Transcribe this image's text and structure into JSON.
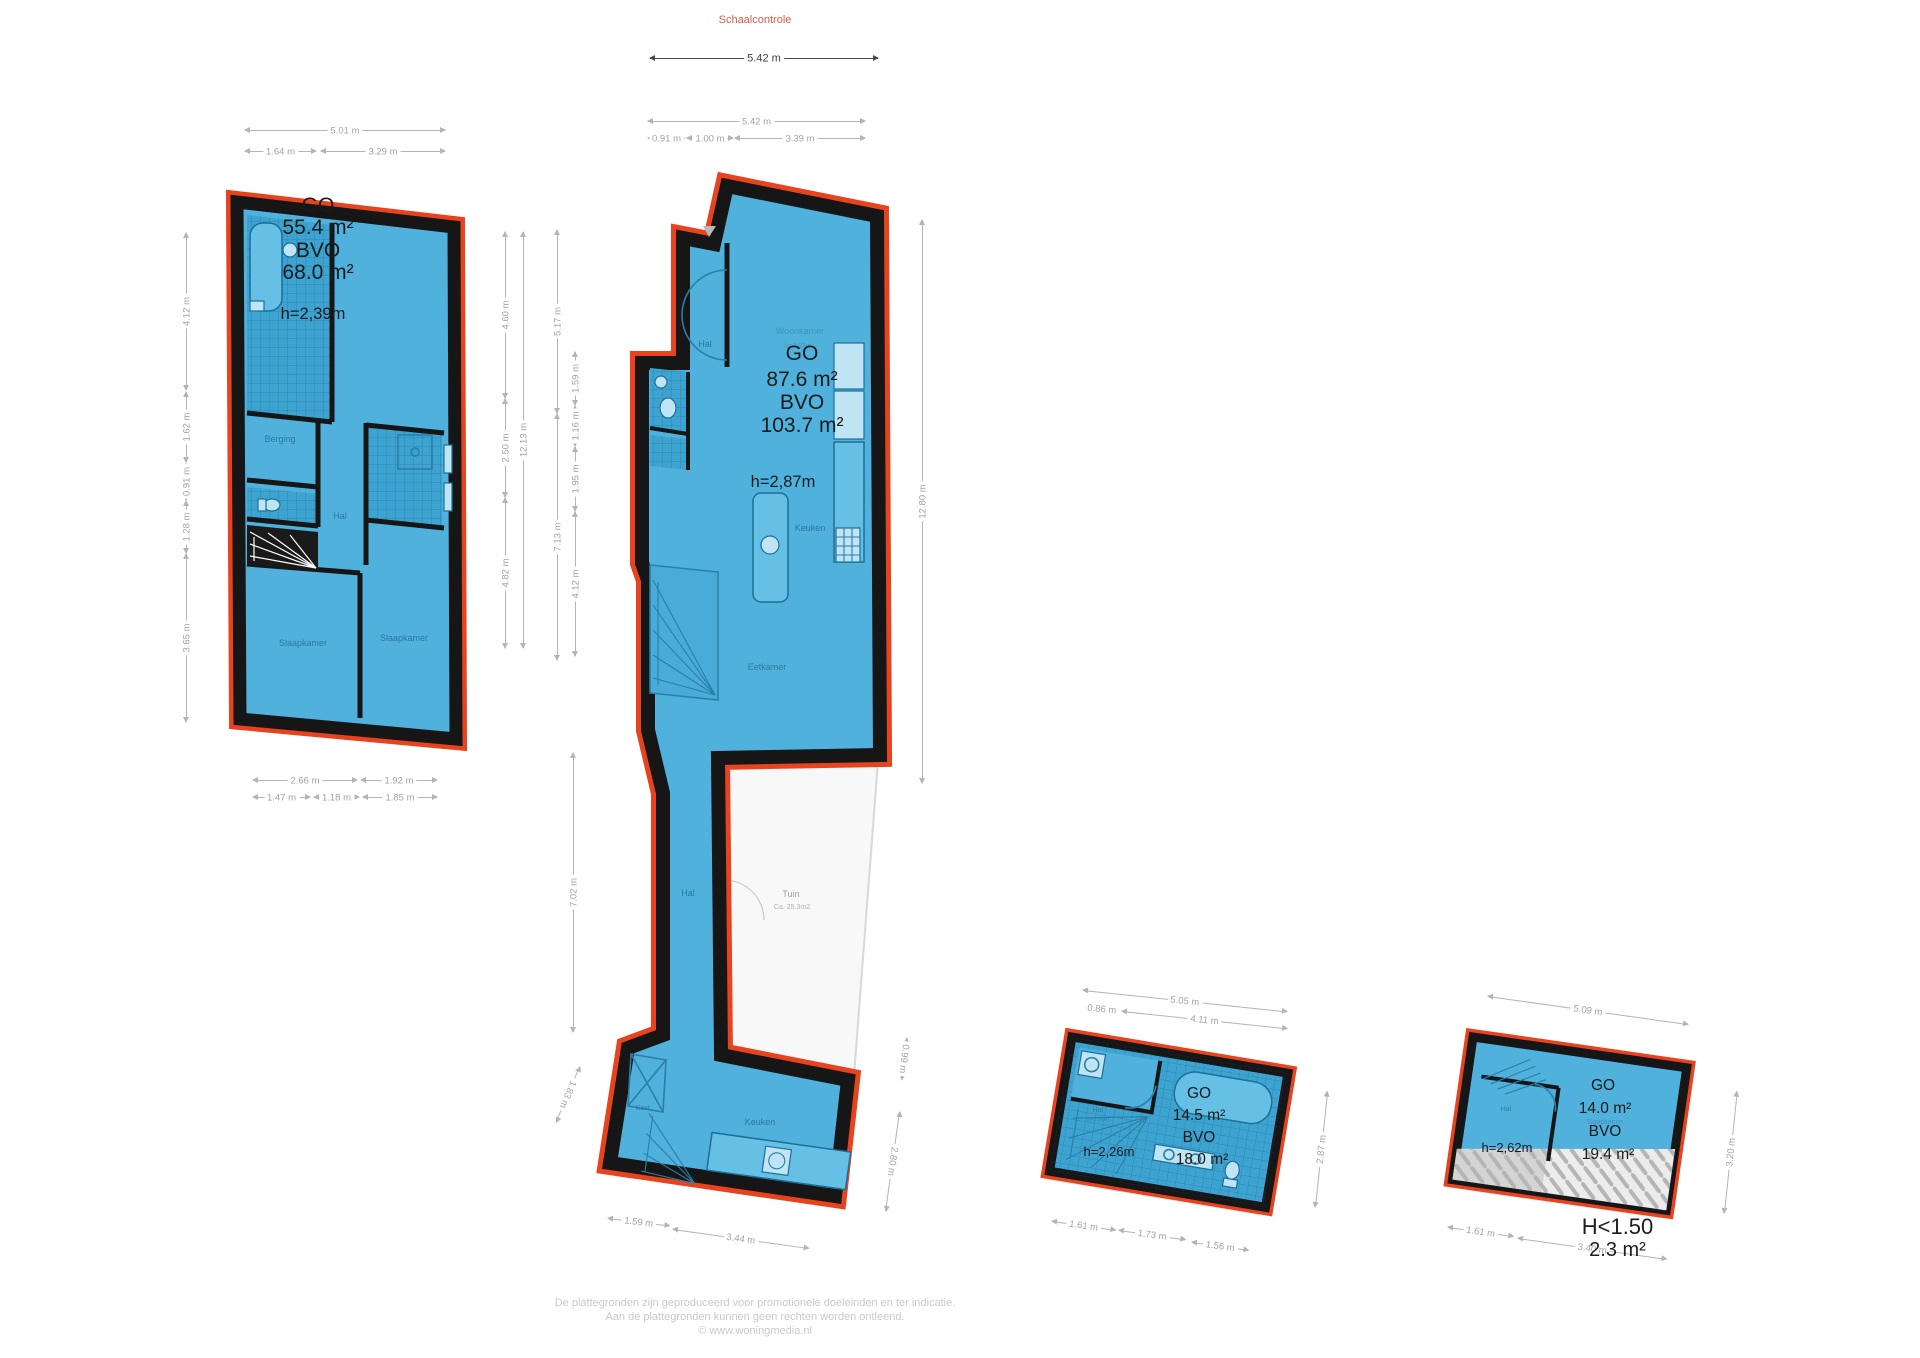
{
  "header": {
    "title": "Schaalcontrole"
  },
  "colors": {
    "accent_red": "#e8431f",
    "plan_blue": "#4fb1dc",
    "plan_blue_tiled": "#3da4d2",
    "wall_black": "#161616",
    "dim_gray": "#b4b4b4",
    "room_label_blue": "#2c7396",
    "title_red": "#d95b47",
    "footer_gray": "#c9c9c9"
  },
  "plans": {
    "first_floor": {
      "go_label": "GO",
      "go_value": "55.4 m²",
      "bvo_label": "BVO",
      "bvo_value": "68.0 m²",
      "height": "h=2,39m",
      "rooms": {
        "berging": "Berging",
        "hal": "Hal",
        "bedroom_left": "Slaapkamer",
        "bedroom_right": "Slaapkamer"
      }
    },
    "ground_floor": {
      "go_label": "GO",
      "go_value": "87.6 m²",
      "bvo_label": "BVO",
      "bvo_value": "103.7 m²",
      "height": "h=2,87m",
      "rooms": {
        "woonkamer": "Woonkamer",
        "woonkamer_h": "h=2,87m",
        "hal": "Hal",
        "keuken": "Keuken",
        "eetkamer": "Eetkamer",
        "hal2": "Hal",
        "tuin": "Tuin",
        "tuin_area": "Ca. 25.3m2",
        "kast": "Kast",
        "keuken2": "Keuken"
      }
    },
    "mezzanine": {
      "go_label": "GO",
      "go_value": "14.5 m²",
      "bvo_label": "BVO",
      "bvo_value": "18.0 m²",
      "height": "h=2,26m",
      "rooms": {
        "hal": "Hal",
        "hal_h": "h=2.26m"
      }
    },
    "attic": {
      "go_label": "GO",
      "go_value": "14.0 m²",
      "bvo_label": "BVO",
      "bvo_value": "19.4 m²",
      "height": "h=2,62m",
      "rooms": {
        "hal": "Hal",
        "slaapkamer": "Slaapkamer"
      },
      "low_height": {
        "line1": "H<1.50",
        "line2": "2.3 m²"
      }
    }
  },
  "dimensions": {
    "scale_check": [
      [
        650,
        58,
        228,
        0,
        "5.42 m",
        "dark"
      ]
    ],
    "first_floor": [
      [
        245,
        130,
        200,
        0,
        "5.01 m"
      ],
      [
        245,
        151,
        71,
        0,
        "1.64 m"
      ],
      [
        321,
        151,
        124,
        0,
        "3.29 m"
      ],
      [
        186,
        390,
        157,
        -90,
        "4.12 m"
      ],
      [
        186,
        462,
        70,
        -90,
        "1.62 m"
      ],
      [
        186,
        500,
        37,
        -90,
        "0.91 m"
      ],
      [
        186,
        553,
        52,
        -90,
        "1.28 m"
      ],
      [
        186,
        722,
        168,
        -90,
        "3.65 m"
      ],
      [
        253,
        780,
        104,
        0,
        "2.66 m"
      ],
      [
        361,
        780,
        76,
        0,
        "1.92 m"
      ],
      [
        253,
        797,
        57,
        0,
        "1.47 m"
      ],
      [
        314,
        797,
        45,
        0,
        "1.18 m"
      ],
      [
        363,
        797,
        74,
        0,
        "1.85 m"
      ]
    ],
    "ground_floor": [
      [
        648,
        121,
        217,
        0,
        "5.42 m"
      ],
      [
        648,
        138,
        37,
        0,
        "0.91 m"
      ],
      [
        687,
        138,
        46,
        0,
        "1.00 m"
      ],
      [
        735,
        138,
        130,
        0,
        "3.39 m"
      ],
      [
        505,
        398,
        166,
        -90,
        "4.60 m"
      ],
      [
        505,
        497,
        98,
        -90,
        "2.50 m"
      ],
      [
        505,
        648,
        150,
        -90,
        "4.82 m"
      ],
      [
        523,
        648,
        416,
        -90,
        "12.13 m"
      ],
      [
        557,
        413,
        183,
        -90,
        "5.17 m"
      ],
      [
        557,
        660,
        246,
        -90,
        "7.13 m"
      ],
      [
        575,
        405,
        53,
        -90,
        "1.59 m"
      ],
      [
        575,
        446,
        40,
        -90,
        "1.16 m"
      ],
      [
        575,
        511,
        64,
        -90,
        "1.95 m"
      ],
      [
        575,
        656,
        144,
        -90,
        "4.12 m"
      ],
      [
        922,
        783,
        563,
        -90,
        "12.80 m"
      ],
      [
        573,
        1032,
        279,
        -90,
        "7.02 m"
      ],
      [
        580,
        1067,
        60,
        113,
        "1.83 m"
      ],
      [
        907,
        1038,
        42,
        97,
        "0.99 m"
      ],
      [
        900,
        1112,
        100,
        98,
        "2.80 m"
      ],
      [
        608,
        1218,
        62,
        7,
        "1.59 m"
      ],
      [
        673,
        1229,
        137,
        8,
        "3.44 m"
      ]
    ],
    "mezzanine": [
      [
        1083,
        990,
        205,
        6,
        "5.05 m"
      ],
      [
        1085,
        1007,
        34,
        6,
        "0.86 m"
      ],
      [
        1122,
        1011,
        166,
        6,
        "4.11 m"
      ],
      [
        1315,
        1207,
        116,
        -84,
        "2.87 m"
      ],
      [
        1052,
        1221,
        64,
        8,
        "1.61 m"
      ],
      [
        1119,
        1230,
        67,
        8,
        "1.73 m"
      ],
      [
        1192,
        1242,
        57,
        8,
        "1.56 m"
      ]
    ],
    "attic": [
      [
        1488,
        996,
        202,
        8,
        "5.09 m"
      ],
      [
        1724,
        1213,
        122,
        -84,
        "3.20 m"
      ],
      [
        1448,
        1227,
        66,
        8,
        "1.61 m"
      ],
      [
        1518,
        1238,
        150,
        8,
        "3.40 m"
      ]
    ]
  },
  "footer": {
    "line1": "De plattegronden zijn geproduceerd voor promotionele doeleinden en ter indicatie.",
    "line2": "Aan de plattegronden kunnen geen rechten worden ontleend.",
    "line3": "© www.woningmedia.nl"
  }
}
